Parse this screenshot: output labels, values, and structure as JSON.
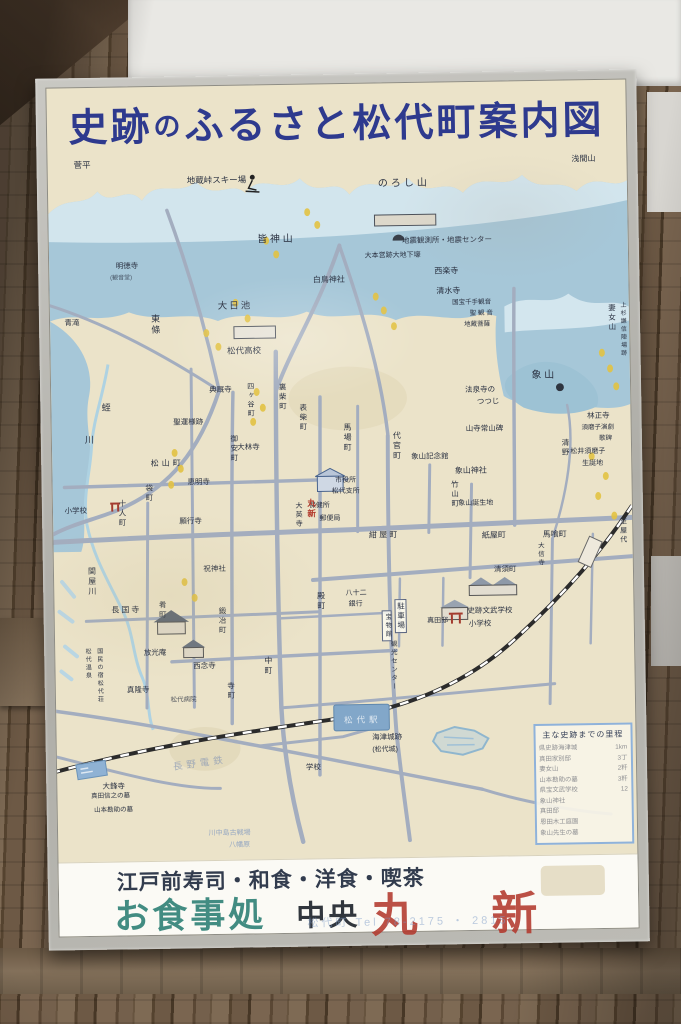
{
  "sign": {
    "title_parts": [
      "史跡",
      "の",
      "ふるさと松代町案内図"
    ],
    "title_full": "史跡のふるさと松代町案内図"
  },
  "colors": {
    "title_blue": "#2e3a8e",
    "board_cream": "#ebe3c9",
    "mountain_blue": "#a6c7d8",
    "road_gray": "#a3adbf",
    "red_accent": "#b3392d",
    "teal_accent": "#2e8176"
  },
  "map": {
    "labels": [
      {
        "t": "菅平",
        "x": 4.5,
        "y": 1.0,
        "s": 8.5
      },
      {
        "t": "浅間山",
        "x": 90.5,
        "y": 1.3,
        "s": 8
      },
      {
        "t": "地蔵峠スキー場",
        "x": 24,
        "y": 3.4,
        "s": 8.5
      },
      {
        "t": "のろし山",
        "x": 57,
        "y": 4.2,
        "s": 10,
        "ls": 3
      },
      {
        "t": "皆 神 山",
        "x": 36,
        "y": 11.8,
        "s": 10
      },
      {
        "t": "地震観測所・地震センター",
        "x": 61,
        "y": 12.4,
        "s": 7.5
      },
      {
        "t": "大本営跡大地下壕",
        "x": 54.5,
        "y": 14.5,
        "s": 7
      },
      {
        "t": "西楽寺",
        "x": 66.5,
        "y": 16.8,
        "s": 8
      },
      {
        "t": "清水寺",
        "x": 66.8,
        "y": 19.6,
        "s": 8
      },
      {
        "t": "国宝千手観音",
        "x": 69.5,
        "y": 21.4,
        "s": 6.5
      },
      {
        "t": "聖 観 音",
        "x": 72.5,
        "y": 23.0,
        "s": 6.5
      },
      {
        "t": "地蔵菩薩",
        "x": 71.5,
        "y": 24.6,
        "s": 6.5
      },
      {
        "t": "白鳥神社",
        "x": 45.5,
        "y": 17.8,
        "s": 8
      },
      {
        "t": "明徳寺",
        "x": 11.5,
        "y": 15.4,
        "s": 7.5
      },
      {
        "t": "(観音堂)",
        "x": 10.5,
        "y": 17.2,
        "s": 6,
        "o": 0.75
      },
      {
        "t": "青滝",
        "x": 2.5,
        "y": 23.3,
        "s": 7.5
      },
      {
        "t": "東條",
        "x": 17.3,
        "y": 22.8,
        "s": 9,
        "v": 1
      },
      {
        "t": "大日池",
        "x": 29,
        "y": 21.2,
        "s": 9.5,
        "ls": 2
      },
      {
        "t": "松代高校",
        "x": 30.5,
        "y": 27.6,
        "s": 8.5
      },
      {
        "t": "妻女山",
        "x": 96.4,
        "y": 22.3,
        "s": 7.5,
        "v": 1
      },
      {
        "t": "上杉謙信陣場跡",
        "x": 98.3,
        "y": 22.0,
        "s": 6,
        "v": 1
      },
      {
        "t": "象 山",
        "x": 83,
        "y": 31.6,
        "s": 10
      },
      {
        "t": "林正寺",
        "x": 92.5,
        "y": 37.6,
        "s": 7.5
      },
      {
        "t": "須磨子演劇",
        "x": 91.5,
        "y": 39.4,
        "s": 6.5
      },
      {
        "t": "歌碑",
        "x": 94.5,
        "y": 41.0,
        "s": 6.5
      },
      {
        "t": "松井須磨子",
        "x": 89.5,
        "y": 42.6,
        "s": 7
      },
      {
        "t": "生誕地",
        "x": 91.5,
        "y": 44.3,
        "s": 7
      },
      {
        "t": "清野",
        "x": 88,
        "y": 41.2,
        "s": 7.5,
        "v": 1
      },
      {
        "t": "法泉寺の",
        "x": 71.5,
        "y": 33.6,
        "s": 7.5
      },
      {
        "t": "つつじ",
        "x": 73.5,
        "y": 35.3,
        "s": 7.5
      },
      {
        "t": "山寺常山碑",
        "x": 71.5,
        "y": 39.1,
        "s": 7.5
      },
      {
        "t": "象山記念館",
        "x": 62,
        "y": 43.0,
        "s": 7.5
      },
      {
        "t": "象山神社",
        "x": 69.5,
        "y": 45.0,
        "s": 8
      },
      {
        "t": "竹山町",
        "x": 68.8,
        "y": 46.9,
        "s": 7.5,
        "v": 1
      },
      {
        "t": "象山誕生地",
        "x": 70,
        "y": 49.7,
        "s": 7
      },
      {
        "t": "代官町",
        "x": 58.8,
        "y": 39.8,
        "s": 8,
        "v": 1
      },
      {
        "t": "馬場町",
        "x": 50.3,
        "y": 38.6,
        "s": 8,
        "v": 1
      },
      {
        "t": "市役所",
        "x": 48.8,
        "y": 46.2,
        "s": 7
      },
      {
        "t": "松代支所",
        "x": 48.2,
        "y": 47.8,
        "s": 7
      },
      {
        "t": "保健所",
        "x": 44.2,
        "y": 49.7,
        "s": 7
      },
      {
        "t": "郵便局",
        "x": 46,
        "y": 51.5,
        "s": 7
      },
      {
        "t": "丸新",
        "x": 43.9,
        "y": 49.2,
        "s": 8.5,
        "v": 1,
        "c": "#b23a2c",
        "b": 1
      },
      {
        "t": "大英寺",
        "x": 41.8,
        "y": 49.6,
        "s": 7,
        "v": 1
      },
      {
        "t": "典厩寺",
        "x": 27.3,
        "y": 33.0,
        "s": 7.5
      },
      {
        "t": "四ヶ谷町",
        "x": 33.8,
        "y": 32.6,
        "s": 7,
        "v": 1
      },
      {
        "t": "裏柴町",
        "x": 39.3,
        "y": 32.8,
        "s": 7.5,
        "v": 1
      },
      {
        "t": "表柴町",
        "x": 42.8,
        "y": 35.8,
        "s": 7.5,
        "v": 1
      },
      {
        "t": "聖運様跡",
        "x": 21,
        "y": 37.6,
        "s": 7.5
      },
      {
        "t": "蛭",
        "x": 8.7,
        "y": 35.3,
        "s": 9
      },
      {
        "t": "川",
        "x": 5.7,
        "y": 39.8,
        "s": 9
      },
      {
        "t": "小学校",
        "x": 2,
        "y": 49.8,
        "s": 7.5
      },
      {
        "t": "松山町",
        "x": 17,
        "y": 43.3,
        "s": 8,
        "ls": 3
      },
      {
        "t": "袋町",
        "x": 16,
        "y": 46.8,
        "s": 7.5,
        "v": 1
      },
      {
        "t": "十人町",
        "x": 11.3,
        "y": 48.8,
        "s": 7.5,
        "v": 1
      },
      {
        "t": "願行寺",
        "x": 21.8,
        "y": 51.6,
        "s": 7.5
      },
      {
        "t": "大林寺",
        "x": 32,
        "y": 41.3,
        "s": 7.5
      },
      {
        "t": "御安町",
        "x": 30.8,
        "y": 40.0,
        "s": 7.5,
        "v": 1
      },
      {
        "t": "恵明寺",
        "x": 23.3,
        "y": 46.0,
        "s": 7.5
      },
      {
        "t": "紺 屋 町",
        "x": 54.5,
        "y": 54.0,
        "s": 8
      },
      {
        "t": "紙屋町",
        "x": 74,
        "y": 54.3,
        "s": 8
      },
      {
        "t": "馬喰町",
        "x": 84.5,
        "y": 54.3,
        "s": 8
      },
      {
        "t": "大信寺",
        "x": 83.3,
        "y": 55.8,
        "s": 6.5,
        "v": 1
      },
      {
        "t": "清須町",
        "x": 76,
        "y": 59.1,
        "s": 7.5
      },
      {
        "t": "殿町",
        "x": 45.3,
        "y": 62.3,
        "s": 8,
        "v": 1
      },
      {
        "t": "八十二",
        "x": 50.3,
        "y": 62.1,
        "s": 7
      },
      {
        "t": "銀行",
        "x": 50.8,
        "y": 63.7,
        "s": 7
      },
      {
        "t": "駐車場",
        "x": 58.8,
        "y": 63.5,
        "s": 7.5,
        "v": 1,
        "box": 1
      },
      {
        "t": "宝物館",
        "x": 56.4,
        "y": 65.1,
        "s": 6.5,
        "v": 1,
        "box": 1
      },
      {
        "t": "真田邸",
        "x": 64.3,
        "y": 66.2,
        "s": 7
      },
      {
        "t": "史跡文武学校",
        "x": 71.3,
        "y": 64.8,
        "s": 7.5
      },
      {
        "t": "小学校",
        "x": 71.5,
        "y": 66.6,
        "s": 7.5
      },
      {
        "t": "観光センター",
        "x": 57.6,
        "y": 69.3,
        "s": 6.5,
        "v": 1
      },
      {
        "t": "中町",
        "x": 36,
        "y": 71.3,
        "s": 8,
        "v": 1
      },
      {
        "t": "寺町",
        "x": 29.6,
        "y": 74.8,
        "s": 7.5,
        "v": 1
      },
      {
        "t": "西念寺",
        "x": 23.8,
        "y": 72.1,
        "s": 7.5
      },
      {
        "t": "鍛冶町",
        "x": 28.3,
        "y": 64.3,
        "s": 7.5,
        "v": 1
      },
      {
        "t": "肴町",
        "x": 18,
        "y": 63.3,
        "s": 7.5,
        "v": 1
      },
      {
        "t": "祝神社",
        "x": 25.8,
        "y": 58.3,
        "s": 7.5
      },
      {
        "t": "長国寺",
        "x": 9.8,
        "y": 64.0,
        "s": 8,
        "ls": 2
      },
      {
        "t": "放光庵",
        "x": 15.3,
        "y": 70.0,
        "s": 7.5
      },
      {
        "t": "松代温泉",
        "x": 5,
        "y": 69.8,
        "s": 6,
        "v": 1
      },
      {
        "t": "国民の宿松代荘",
        "x": 7,
        "y": 69.8,
        "s": 6,
        "v": 1
      },
      {
        "t": "関屋川",
        "x": 5.8,
        "y": 58.3,
        "s": 8,
        "v": 1
      },
      {
        "t": "真隆寺",
        "x": 12.3,
        "y": 75.3,
        "s": 7.5
      },
      {
        "t": "松代病院",
        "x": 19.8,
        "y": 77.0,
        "s": 6.5,
        "o": 0.8
      },
      {
        "t": "長野電鉄",
        "x": 20,
        "y": 85.8,
        "s": 9.5,
        "c": "#96a2b6",
        "o": 0.85,
        "r": -7,
        "ls": 4
      },
      {
        "t": "大鋒寺",
        "x": 7.8,
        "y": 88.8,
        "s": 7.5
      },
      {
        "t": "真田信之の墓",
        "x": 5.8,
        "y": 90.4,
        "s": 6.5
      },
      {
        "t": "山本勘助の墓",
        "x": 6.3,
        "y": 92.4,
        "s": 6.5
      },
      {
        "t": "川中島古戦場",
        "x": 26,
        "y": 95.8,
        "s": 7,
        "c": "#7f98c0",
        "o": 0.8
      },
      {
        "t": "八幡原",
        "x": 29.5,
        "y": 97.5,
        "s": 7,
        "c": "#7f98c0",
        "o": 0.8
      },
      {
        "t": "海津城跡",
        "x": 54.5,
        "y": 82.5,
        "s": 7.5
      },
      {
        "t": "(松代城)",
        "x": 54.5,
        "y": 84.3,
        "s": 7
      },
      {
        "t": "学校",
        "x": 43,
        "y": 86.6,
        "s": 7.5
      },
      {
        "t": "至屋代",
        "x": 97.8,
        "y": 52.6,
        "s": 7,
        "v": 1
      },
      {
        "t": "松代駅",
        "x": 49.7,
        "y": 79.9,
        "s": 8.5,
        "c": "#ffffff",
        "o": 0.75,
        "ls": 4
      }
    ]
  },
  "table": {
    "title": "主な史跡までの里程",
    "rows": [
      {
        "name": "県史跡海津城",
        "dist": "1km"
      },
      {
        "name": "真田家別邸",
        "dist": "3丁"
      },
      {
        "name": "妻女山",
        "dist": "2粁"
      },
      {
        "name": "山本勘助の墓",
        "dist": "3粁"
      },
      {
        "name": "県宝文武学校",
        "dist": "12"
      },
      {
        "name": "象山神社",
        "dist": ""
      },
      {
        "name": "真田邸",
        "dist": ""
      },
      {
        "name": "恩田木工庭園",
        "dist": ""
      },
      {
        "name": "象山先生の墓",
        "dist": ""
      }
    ]
  },
  "ad": {
    "line1": "江戸前寿司・和食・洋食・喫茶",
    "name": "お食事処",
    "shop_chuo": "中央",
    "shop_maru": "丸",
    "shop_shin": "新",
    "tel": "松代町 Tel 78-2175 ・ 2815"
  }
}
